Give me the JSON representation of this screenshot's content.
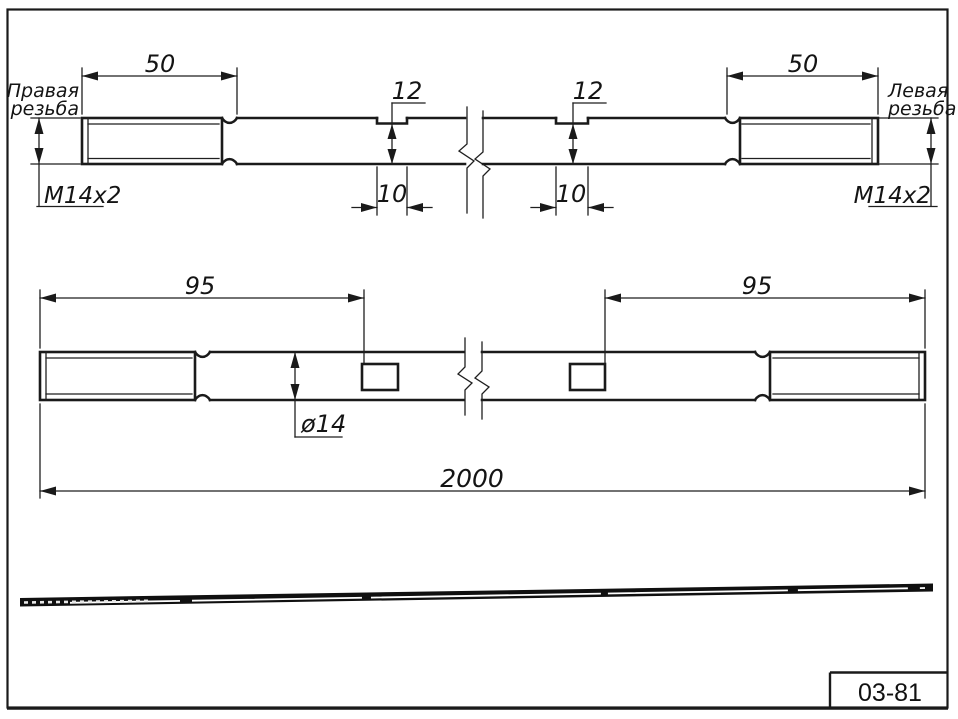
{
  "sheet": {
    "code": "03-81",
    "line_color": "#1a1a1a",
    "background_color": "#ffffff"
  },
  "top_view": {
    "right_hand_thread_label_1": "Правая",
    "right_hand_thread_label_2": "резьба",
    "left_hand_thread_label_1": "Левая",
    "left_hand_thread_label_2": "резьба",
    "thread_spec_left": "M14x2",
    "thread_spec_right": "M14x2",
    "dim_thread_length_left": "50",
    "dim_thread_length_right": "50",
    "dim_flat_depth_left": "12",
    "dim_flat_depth_right": "12",
    "dim_flat_width_left": "10",
    "dim_flat_width_right": "10"
  },
  "front_view": {
    "dim_flat_position_left": "95",
    "dim_flat_position_right": "95",
    "dim_diameter": "ø14",
    "dim_overall_length": "2000"
  }
}
